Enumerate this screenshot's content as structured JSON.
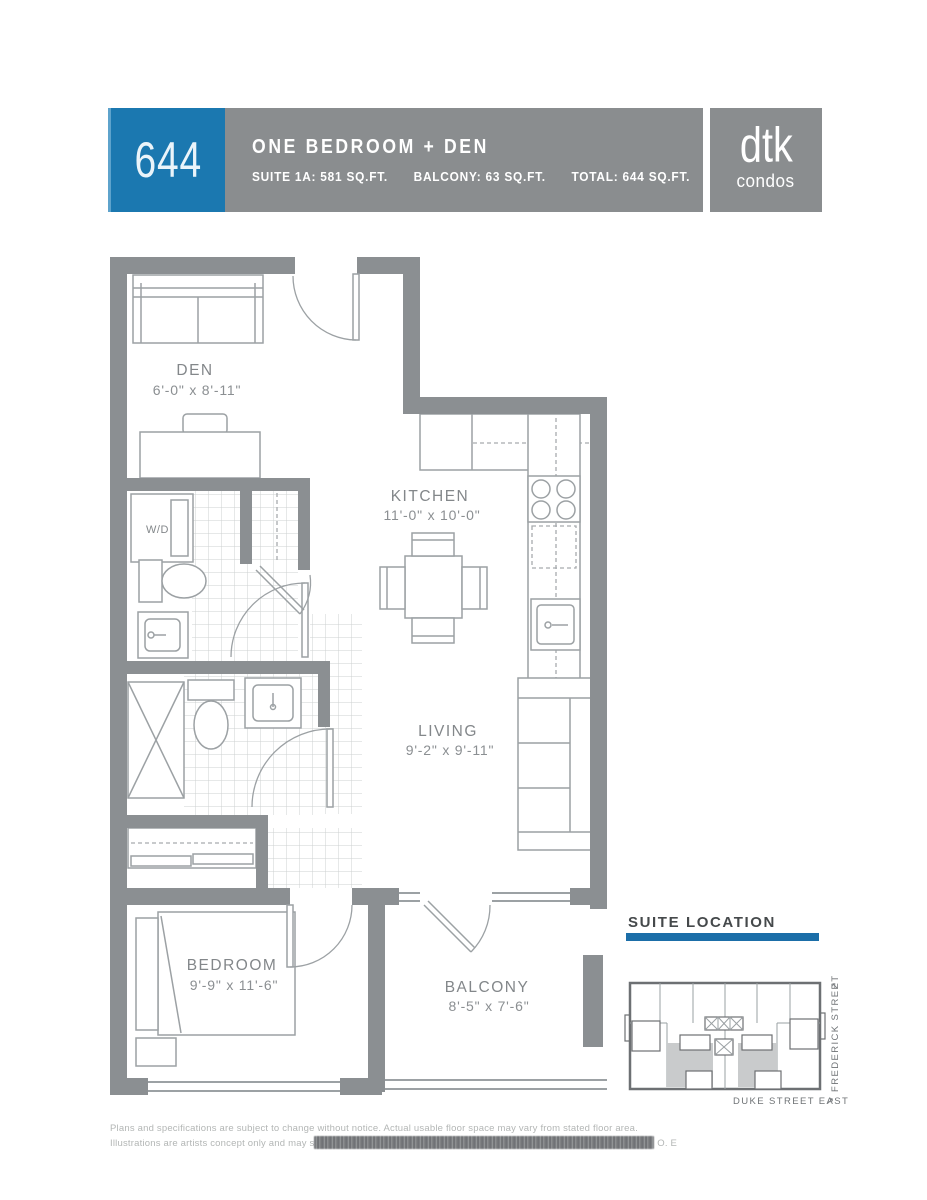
{
  "header": {
    "unit_number": "644",
    "unit_type": "ONE BEDROOM + DEN",
    "suite_area": "SUITE 1A: 581 SQ.FT.",
    "balcony_area": "BALCONY: 63 SQ.FT.",
    "total_area": "TOTAL: 644 SQ.FT.",
    "brand_name": "dtk",
    "brand_sub": "condos"
  },
  "floorplan": {
    "den": {
      "name": "DEN",
      "dims": "6'-0\" x 8'-11\""
    },
    "kitchen": {
      "name": "KITCHEN",
      "dims": "11'-0\" x 10'-0\""
    },
    "living": {
      "name": "LIVING",
      "dims": "9'-2\" x 9'-11\""
    },
    "bedroom": {
      "name": "BEDROOM",
      "dims": "9'-9\" x 11'-6\""
    },
    "balcony": {
      "name": "BALCONY",
      "dims": "8'-5\" x 7'-6\""
    },
    "washer_dryer": "W/D"
  },
  "suite_location": {
    "title": "SUITE LOCATION",
    "street_bottom": "DUKE STREET EAST",
    "street_right": "FREDERICK STREET",
    "arrow": "↗"
  },
  "disclaimer": {
    "line1": "Plans and specifications are subject to change without notice.  Actual usable floor space may vary from stated floor area.",
    "line2_prefix": "Illustrations are artists concept only and may s",
    "line2_suffix": " O. E"
  },
  "colors": {
    "accent_blue": "#1b78b0",
    "header_gray": "#8a8d8f",
    "wall_gray": "#8b8f92"
  }
}
